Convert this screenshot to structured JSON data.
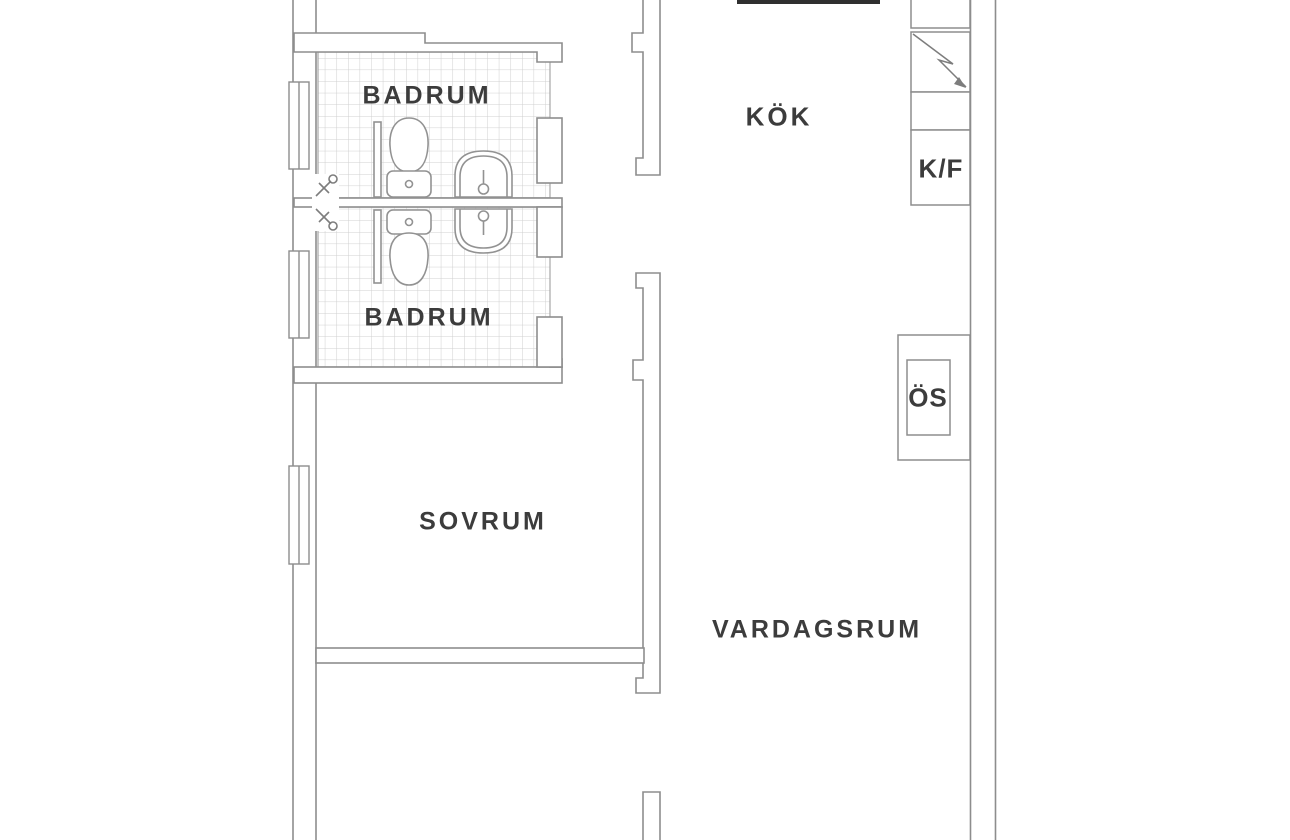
{
  "document": {
    "type": "apartment floor plan",
    "language": "Swedish"
  },
  "rooms": {
    "badrum1": {
      "label": "BADRUM"
    },
    "badrum2": {
      "label": "BADRUM"
    },
    "kok": {
      "label": "KÖK"
    },
    "sovrum": {
      "label": "SOVRUM"
    },
    "vardagsrum": {
      "label": "VARDAGSRUM"
    }
  },
  "cabinets": {
    "kf": {
      "label": "K/F"
    },
    "os": {
      "label": "ÖS"
    }
  },
  "icons": {
    "lightning_icon": "zigzag bolt in kitchen unit box",
    "toilet_icon": "toilet plan symbol (tank + egg bowl)",
    "sink_icon": "arched wash basin with tap",
    "shower_mixer_icon": "diagonal mixer with head circle",
    "window_icon": "wall window rectangle with center line"
  },
  "colors": {
    "background": "#ffffff",
    "wall_line": "#8d8d8d",
    "fixture_line": "#929292",
    "tile_line": "#cfcfcf",
    "tile_edge": "#a6a6a6",
    "label_text": "#3c3c3c",
    "cut_wall_bar": "#2f2f2f"
  }
}
